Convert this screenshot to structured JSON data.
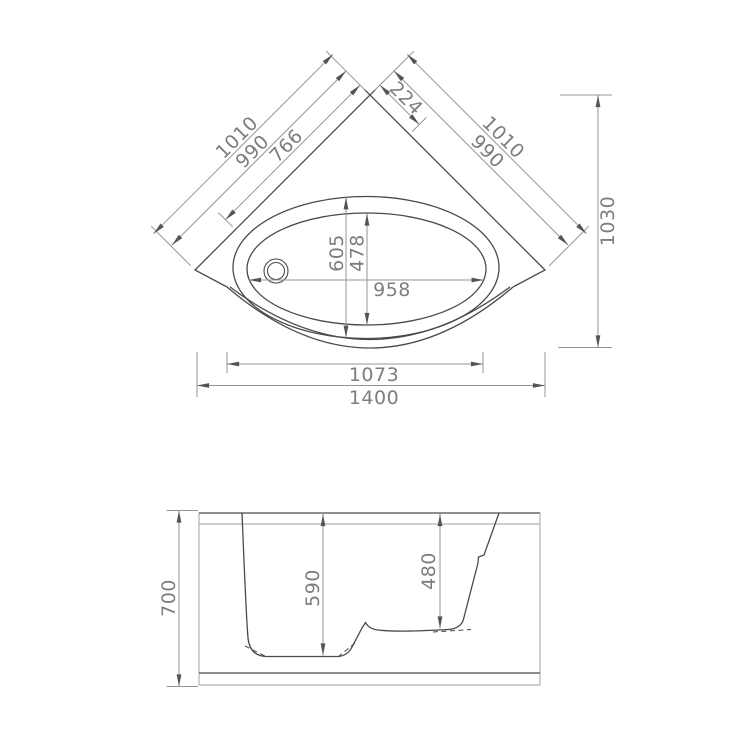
{
  "drawing": {
    "type": "bathtub-technical-drawing",
    "top_view": {
      "left_dims": {
        "outer": "1010",
        "middle": "990",
        "inner": "766"
      },
      "right_dims": {
        "outer": "1010",
        "middle": "990",
        "corner": "224"
      },
      "overall": {
        "height": "1030",
        "width": "1400",
        "front_width": "1073"
      },
      "basin": {
        "length": "958",
        "depth_outer": "605",
        "depth_inner": "478"
      }
    },
    "side_view": {
      "overall_height": "700",
      "main_depth": "590",
      "seat_depth": "480"
    }
  },
  "colors": {
    "background": "#ffffff",
    "outline": "#4a4a4a",
    "dimension_line": "#949494",
    "arrow": "#545454",
    "text": "#7d7d7d",
    "light_line": "#b0b0b0"
  }
}
